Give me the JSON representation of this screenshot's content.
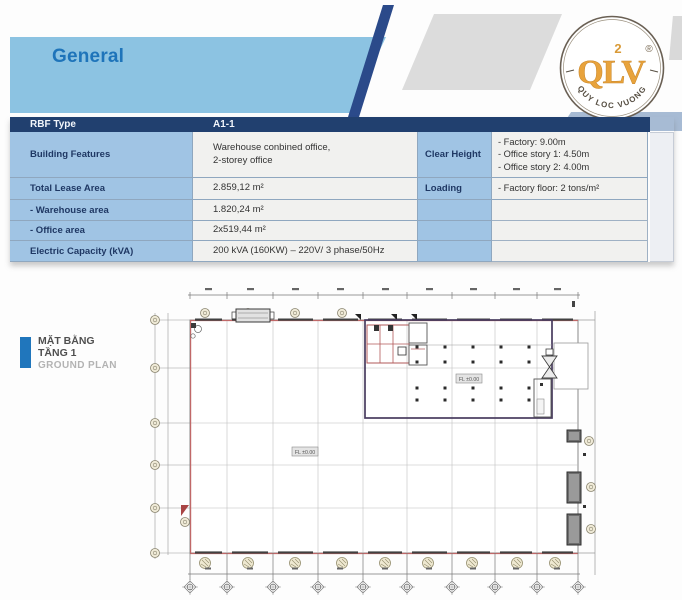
{
  "header": {
    "title": "General"
  },
  "logo": {
    "main": "QLV",
    "sup2": "2",
    "reg": "®",
    "arc_text": "QUY LOC VUONG"
  },
  "table": {
    "header": {
      "type_label": "RBF Type",
      "type_value": "A1-1"
    },
    "rows": [
      {
        "label": "Building Features",
        "value": "Warehouse conbined office,\n2-storey office"
      },
      {
        "label": "Total Lease Area",
        "value": "2.859,12 m²"
      },
      {
        "label": "- Warehouse area",
        "value": "1.820,24 m²"
      },
      {
        "label": "- Office area",
        "value": "2x519,44 m²"
      },
      {
        "label": "Electric Capacity (kVA)",
        "value": "200 kVA (160KW) – 220V/ 3 phase/50Hz"
      }
    ],
    "right_rows": [
      {
        "label": "Clear Height",
        "value": "- Factory: 9.00m\n- Office story 1: 4.50m\n- Office story 2: 4.00m"
      },
      {
        "label": "Loading",
        "value": "- Factory floor: 2 tons/m²"
      }
    ]
  },
  "plan": {
    "label_vi_1": "MẶT BẰNG",
    "label_vi_2": "TẦNG 1",
    "label_en": "GROUND PLAN",
    "level_label": "FL ±0.00"
  },
  "colors": {
    "banner_blue": "#8cc3e2",
    "header_navy": "#21406f",
    "slash_navy": "#2b4a8a",
    "cell_blue": "#a0c4e4",
    "cell_gray": "#f1f1ef",
    "title_blue": "#1e74ba",
    "logo_orange": "#e8a33c",
    "plan_red": "#c06868"
  }
}
